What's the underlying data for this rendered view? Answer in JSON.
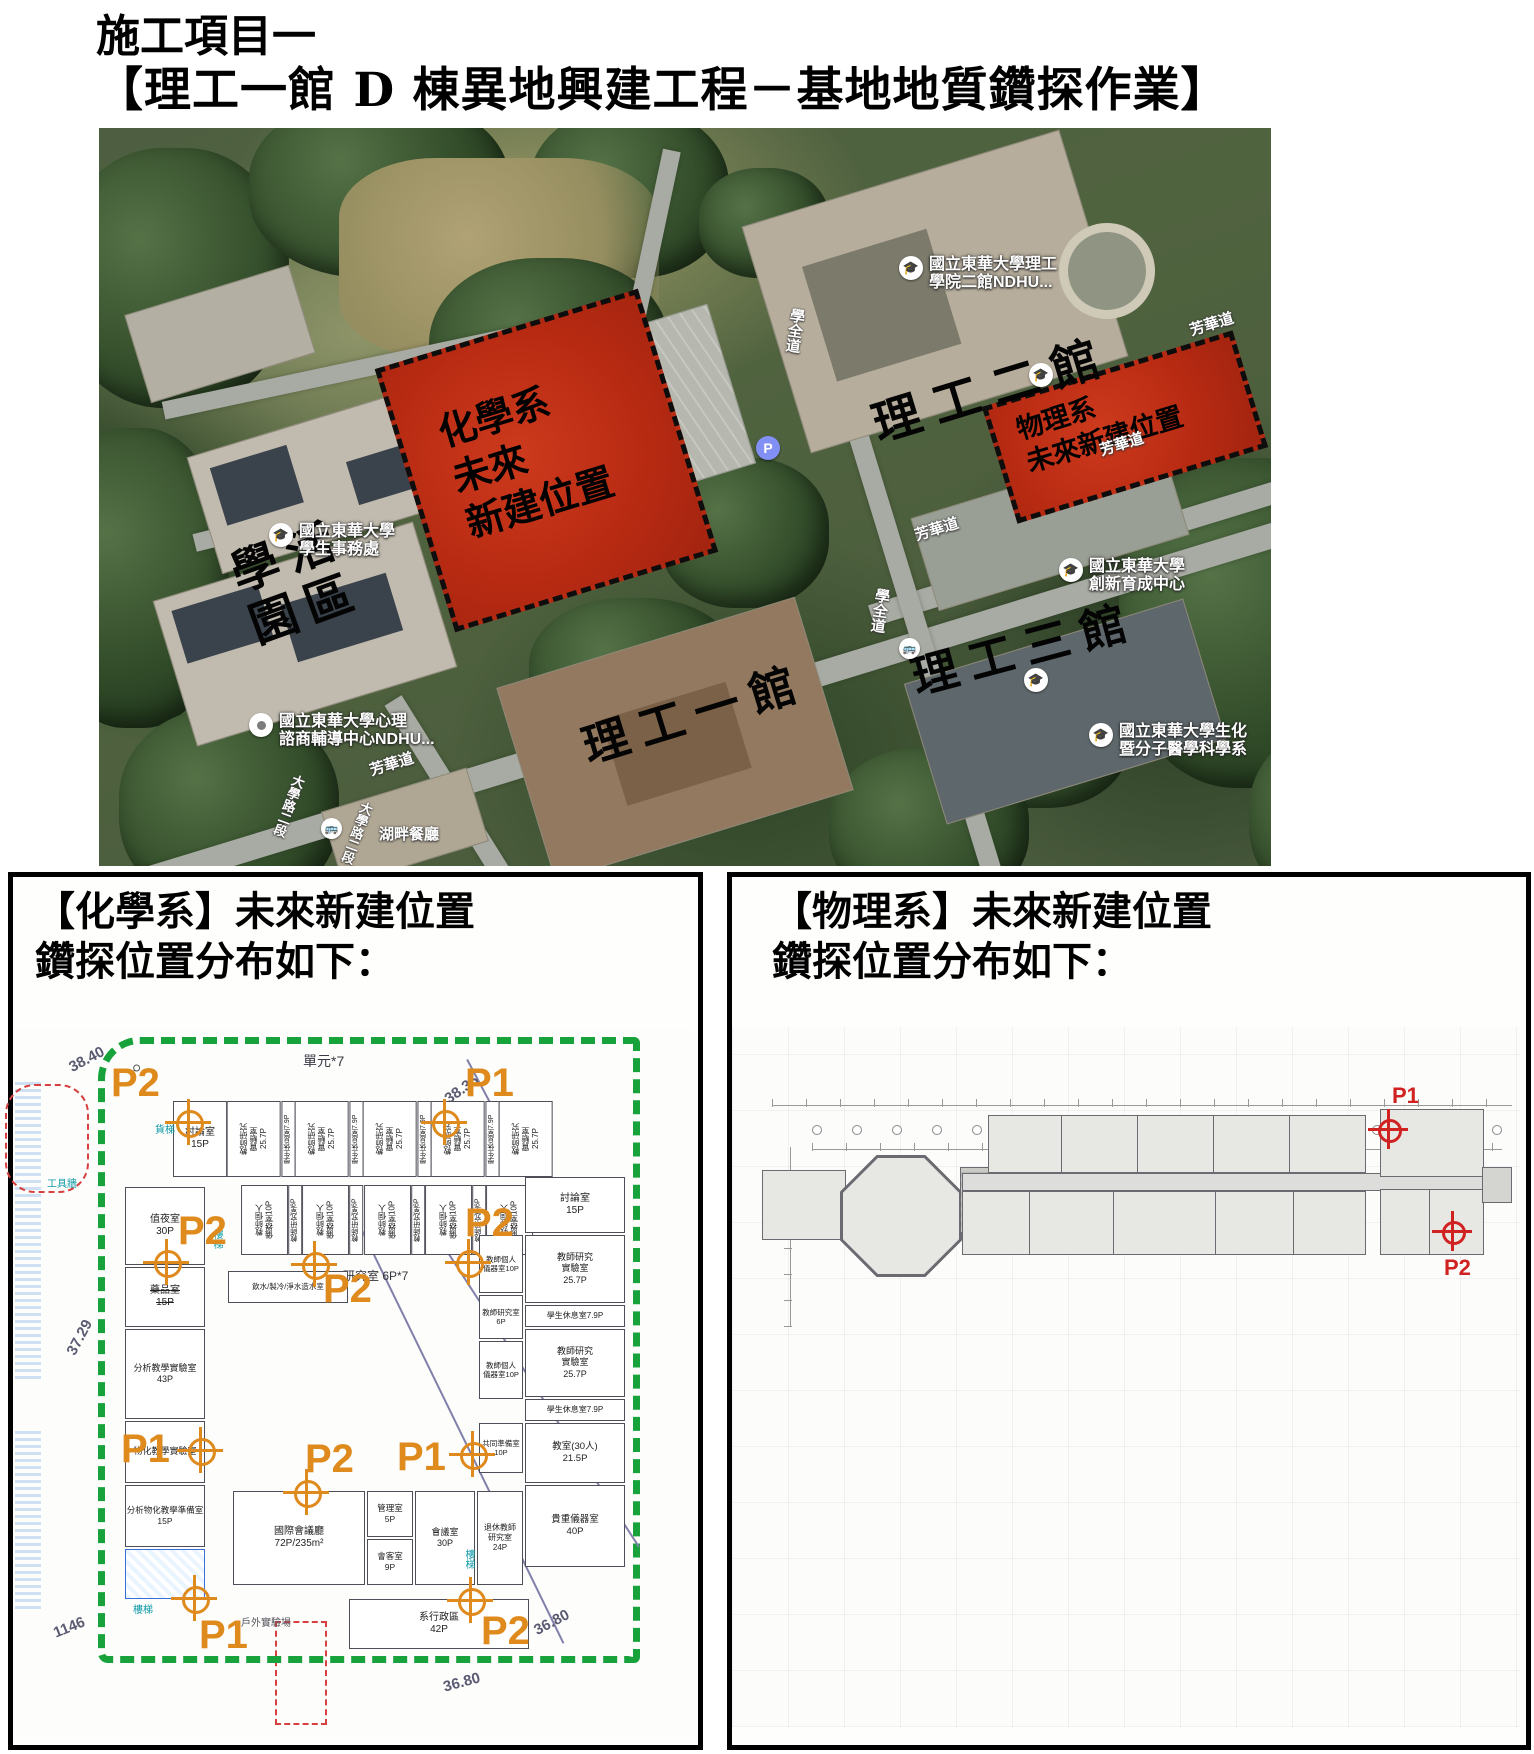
{
  "title": {
    "line1": "施工項目一",
    "line2": "【理工一館 D 棟異地興建工程－基地地質鑽探作業】"
  },
  "map": {
    "building_labels": [
      "理工二館",
      "學活\n園區",
      "理工一館",
      "理工三館"
    ],
    "zones": {
      "chemistry": "化學系\n未來\n新建位置",
      "physics": "物理系\n未來新建位置"
    },
    "pois": [
      {
        "name": "國立東華大學理工\n學院二館NDHU...",
        "icon": "school"
      },
      {
        "name": "國立東華大學\n學生事務處",
        "icon": "school"
      },
      {
        "name": "國立東華大學心理\n諮商輔導中心NDHU...",
        "icon": "pin"
      },
      {
        "name": "國立東華大學\n創新育成中心",
        "icon": "school"
      },
      {
        "name": "國立東華大學生化\n暨分子醫學科學系",
        "icon": "school"
      },
      {
        "name": "湖畔餐廳",
        "icon": "none"
      }
    ],
    "roads": {
      "fanghua": "芳華道",
      "xuequan": "學全道",
      "daxue": "大學路二段"
    },
    "icons": {
      "parking_label": "P",
      "school_glyph": "🎓",
      "bus_glyph": "🚌"
    },
    "colors": {
      "zone_red": "#b72a12",
      "label_black": "#040404"
    }
  },
  "chem": {
    "header1": "【化學系】未來新建位置",
    "header2": "鑽探位置分布如下：",
    "markers": {
      "p1": "P1",
      "p2": "P2"
    },
    "labels": {
      "unit": "單元*7",
      "c3840": "38.40",
      "c3835": "38.35",
      "c3729": "37.29",
      "c3746": "37.46",
      "c1146": "1146",
      "c1147": "1147",
      "c3680": "36.80",
      "magnifier": "⌕",
      "research67": "研究室 6P*7",
      "outdoor": "戶外實驗場",
      "cargo_lift": "貨梯",
      "stair": "樓梯",
      "tool_wall": "工具牆"
    },
    "rooms": {
      "discuss15": "討論室\n15P",
      "teacher_lab": "教師研究\n實驗室\n25.7P",
      "student_rest": "學生休息室7.9P",
      "teacher_personal": "教師個人\n儀器室10P",
      "teacher_office": "教師研究室6P",
      "night30": "值夜室\n30P",
      "med15": "藥品室\n15P",
      "ana43": "分析教學實驗室\n43P",
      "phychem_lab": "物化教學實驗室",
      "prep15": "分析物化教學準備室\n15P",
      "common10": "共同準備室\n10P",
      "class30": "教室(30人)\n21.5P",
      "heavy40": "貴重儀器室\n40P",
      "water_room": "飲水/製冷/淨水造水室",
      "conf": "國際會議廳\n72P/235m²",
      "mgr5": "管理室\n5P",
      "guest9": "會客室\n9P",
      "meeting30": "會議室\n30P",
      "retire24": "退休教師\n研究室\n24P",
      "admin42": "系行政區\n42P"
    },
    "marker_color": "#df8a1d",
    "boundary_color": "#18a23b"
  },
  "phys": {
    "header1": "【物理系】未來新建位置",
    "header2": "鑽探位置分布如下：",
    "markers": {
      "p1": "P1",
      "p2": "P2"
    },
    "marker_color": "#d12222"
  }
}
